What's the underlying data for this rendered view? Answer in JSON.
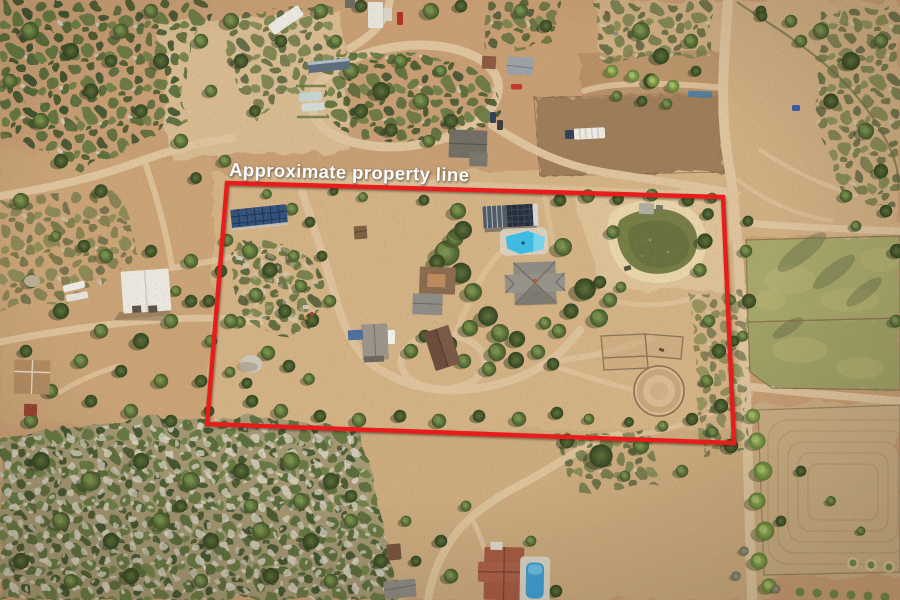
{
  "annotation": {
    "label": "Approximate property line",
    "text_color": "#ffffff",
    "line_color": "#e91d1a"
  },
  "scene": {
    "type": "aerial-drone-photo",
    "subject": "rural ranch property outlined in red amid chaparral hillside, dirt roads, pastures and neighboring homesteads",
    "features": [
      "property-boundary-outline",
      "solar-panel-array",
      "workshop-with-solar-roof",
      "swimming-pool",
      "main-residence",
      "barn-courtyard-building",
      "rust-roof-outbuilding",
      "west-cottage",
      "dome-tent",
      "irrigation-pond",
      "round-pen-horse-arena",
      "horse-corrals",
      "interior-driveway-loop",
      "white-warehouse-barn",
      "rv-trailers",
      "neighbor-homestead-cluster",
      "fenced-green-paddocks",
      "tilled-field",
      "orchard-rows",
      "dirt-roads",
      "chaparral-and-granite-boulders",
      "south-house-with-pool"
    ]
  },
  "palette": {
    "terrain": "#c79d73",
    "dirt_light": "#d5b68c",
    "dirt_road": "#ddc39c",
    "scrub_green": "#5b6d3b",
    "tree_green": "#46592f",
    "pasture": "#a6a66b",
    "pond_water": "#757c44",
    "pond_bank": "#e7d4a9",
    "pool_water": "#3cbce4",
    "roof_gray": "#8e8a82",
    "roof_rust": "#6b4c3c",
    "solar_blue": "#31517c",
    "warehouse_white": "#e9e7de",
    "rock_gray": "#d7d1c3"
  }
}
